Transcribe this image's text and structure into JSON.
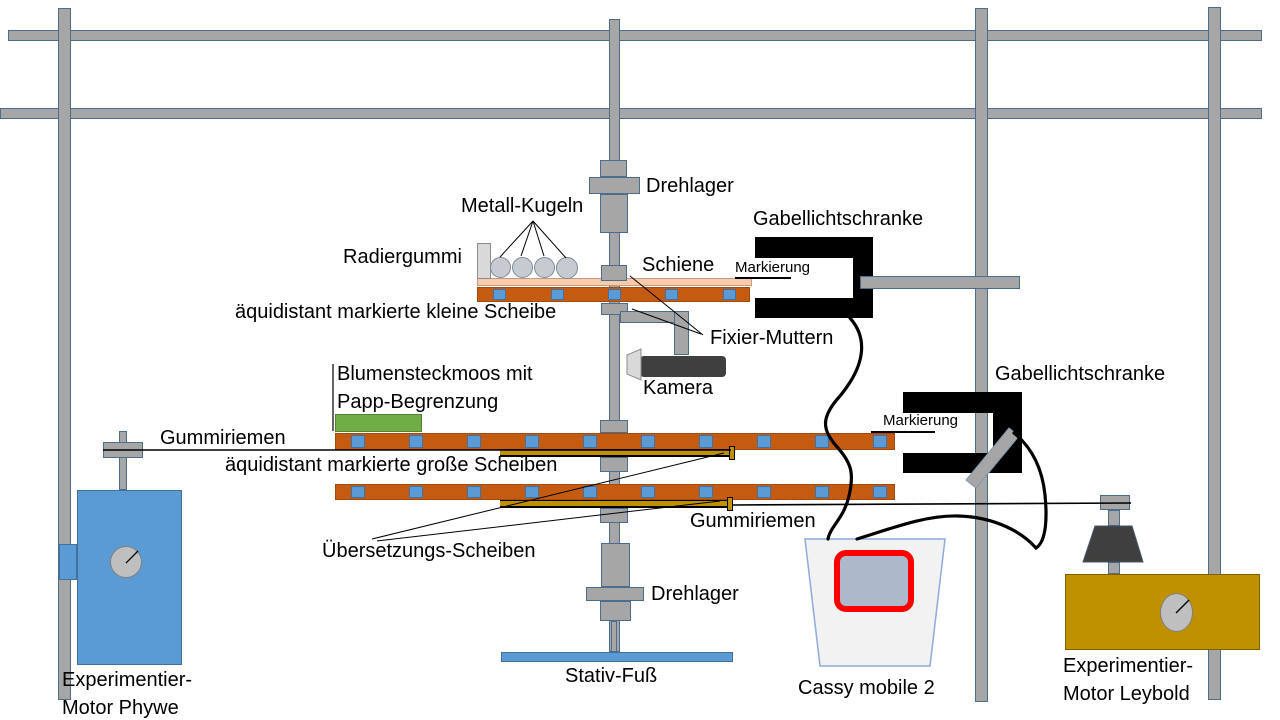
{
  "diagram": {
    "labels": {
      "drehlager_top": "Drehlager",
      "metall_kugeln": "Metall-Kugeln",
      "radiergummi": "Radiergummi",
      "schiene": "Schiene",
      "markierung_top": "Markierung",
      "gabellichtschranke_top": "Gabellichtschranke",
      "kleine_scheibe": "äquidistant markierte kleine Scheibe",
      "fixier_muttern": "Fixier-Muttern",
      "kamera": "Kamera",
      "blumensteckmoos_1": "Blumensteckmoos mit",
      "blumensteckmoos_2": "Papp-Begrenzung",
      "gummiriemen_links": "Gummiriemen",
      "grosse_scheiben": "äquidistant markierte große Scheiben",
      "gabellichtschranke_rechts": "Gabellichtschranke",
      "markierung_rechts": "Markierung",
      "uebersetzungs_scheiben": "Übersetzungs-Scheiben",
      "gummiriemen_rechts": "Gummiriemen",
      "drehlager_unten": "Drehlager",
      "stativ_fuss": "Stativ-Fuß",
      "cassy": "Cassy mobile 2",
      "motor_links_1": "Experimentier-",
      "motor_links_2": "Motor Phywe",
      "motor_rechts_1": "Experimentier-",
      "motor_rechts_2": "Motor Leybold"
    },
    "colors": {
      "frame": "#A6A6A6",
      "frame_border": "#4E6C8C",
      "disc_orange": "#C55A11",
      "disc_border": "#A34A0D",
      "square_blue": "#5B9BD5",
      "square_border": "#41719C",
      "schiene": "#F8CBAD",
      "schiene_border": "#C99B7C",
      "green": "#70AD47",
      "green_border": "#548235",
      "olive": "#BF9000",
      "motor_blue": "#5B9BD5",
      "motor_blue_border": "#41719C",
      "gold": "#BF9000",
      "gold_border": "#7F6000",
      "dark": "#3F3F3F",
      "ball": "#C6CBD2",
      "ball_border": "#7F8B99",
      "eraser": "#D9D9D9",
      "eraser_border": "#8C8C8C",
      "dial": "#BFBFBF",
      "dial_border": "#7F7F7F",
      "cassy_body": "#F2F2F2",
      "cassy_border": "#8FAADC",
      "screen_red": "#FF0000",
      "screen_fill": "#ACB9CA",
      "cable": "#000000"
    }
  }
}
